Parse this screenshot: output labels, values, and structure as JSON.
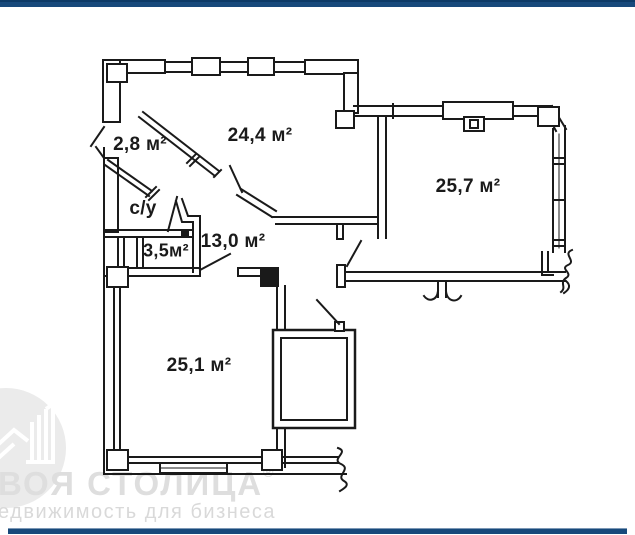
{
  "watermark": {
    "brand": "ВОЯ СТОЛИЦА",
    "reg": "®",
    "tagline": "едвижимость для бизнеса"
  },
  "rooms": {
    "hall": "2,8 м²",
    "living": "24,4 м²",
    "room_right": "25,7 м²",
    "wc": "с/у",
    "storage": "3,5м²",
    "corridor": "13,0 м²",
    "room_bottom": "25,1 м²"
  },
  "colors": {
    "accent": "#17497B",
    "wall": "#1A1A1A",
    "watermark_gray": "#DEDEDE"
  }
}
